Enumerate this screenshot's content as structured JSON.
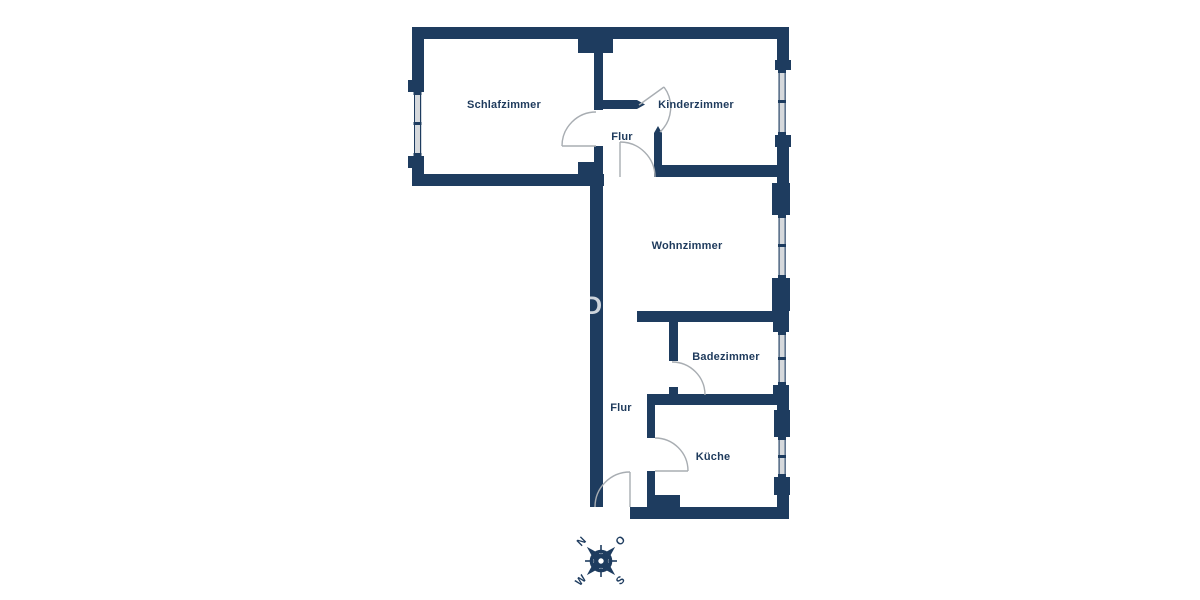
{
  "plan": {
    "rooms": {
      "schlafzimmer": {
        "label": "Schlafzimmer"
      },
      "kinderzimmer": {
        "label": "Kinderzimmer"
      },
      "flur_upper": {
        "label": "Flur"
      },
      "wohnzimmer": {
        "label": "Wohnzimmer"
      },
      "badezimmer": {
        "label": "Badezimmer"
      },
      "flur_lower": {
        "label": "Flur"
      },
      "kueche": {
        "label": "Küche"
      }
    },
    "compass": {
      "north": "N",
      "east": "O",
      "south": "S",
      "west": "W"
    },
    "watermark": {
      "text": "DI"
    },
    "colors": {
      "wall": "#1e3c5f",
      "label": "#1e3a5c",
      "door_arc": "#a8adb2",
      "window_glass": "#d6d9dc",
      "background": "#ffffff"
    }
  }
}
